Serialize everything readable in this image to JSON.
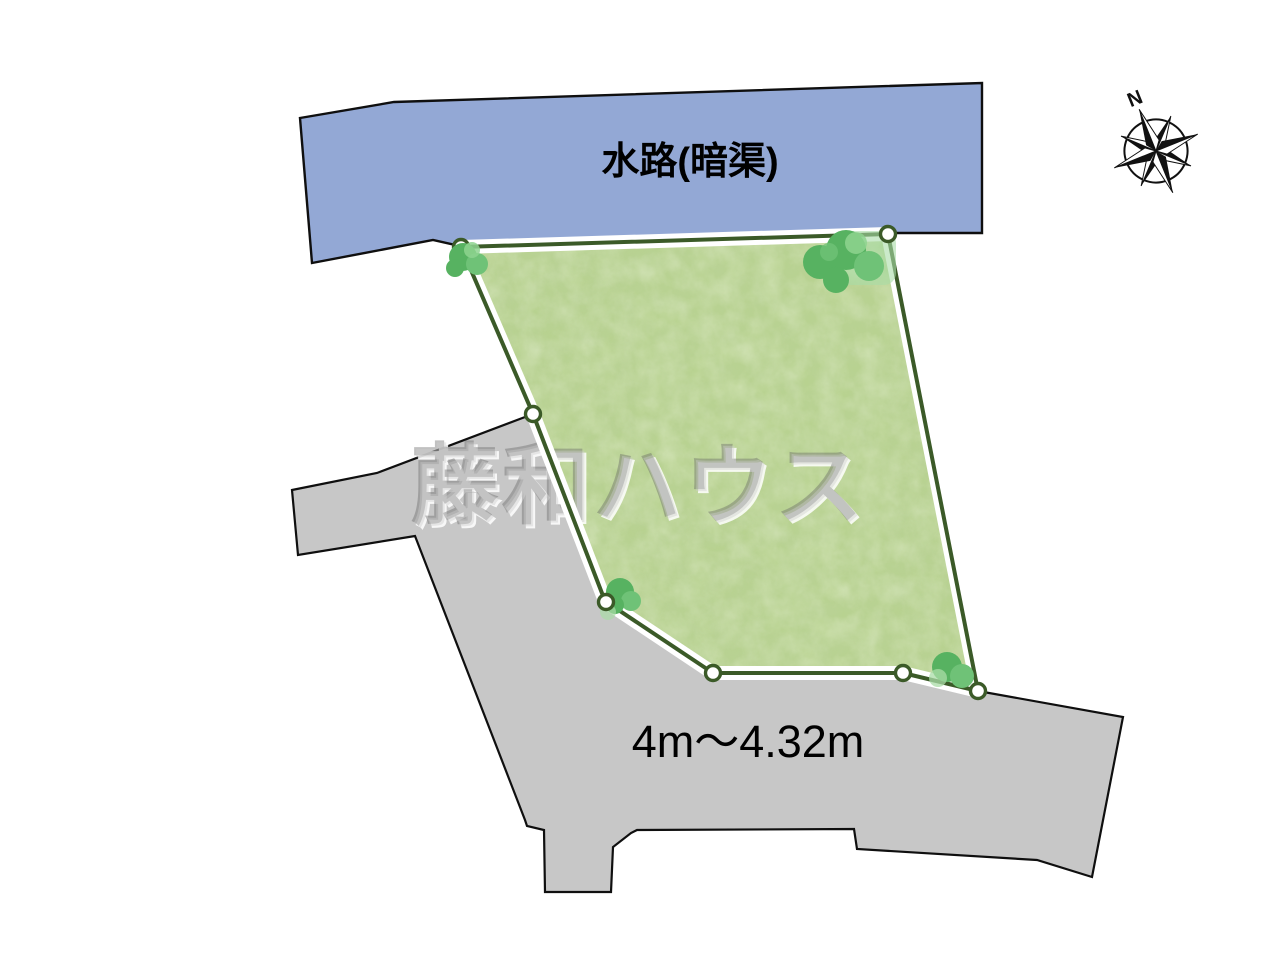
{
  "plan": {
    "waterway_label": "水路(暗渠)",
    "road_width_label": "4m～4.32m",
    "watermark_text": "藤和ハウス",
    "compass_north_label": "N"
  },
  "colors": {
    "water": "#93a8d5",
    "road": "#c7c7c7",
    "line-black": "#0f0f0f",
    "plot-fill": "#b8d290",
    "plot-outline": "#3b5a28",
    "casing": "#ffffff",
    "tree-a": "#57b261",
    "tree-b": "#6fc277",
    "tree-c": "#8ed38f",
    "tree-pale": "#a9dca7",
    "label": "#000000"
  }
}
